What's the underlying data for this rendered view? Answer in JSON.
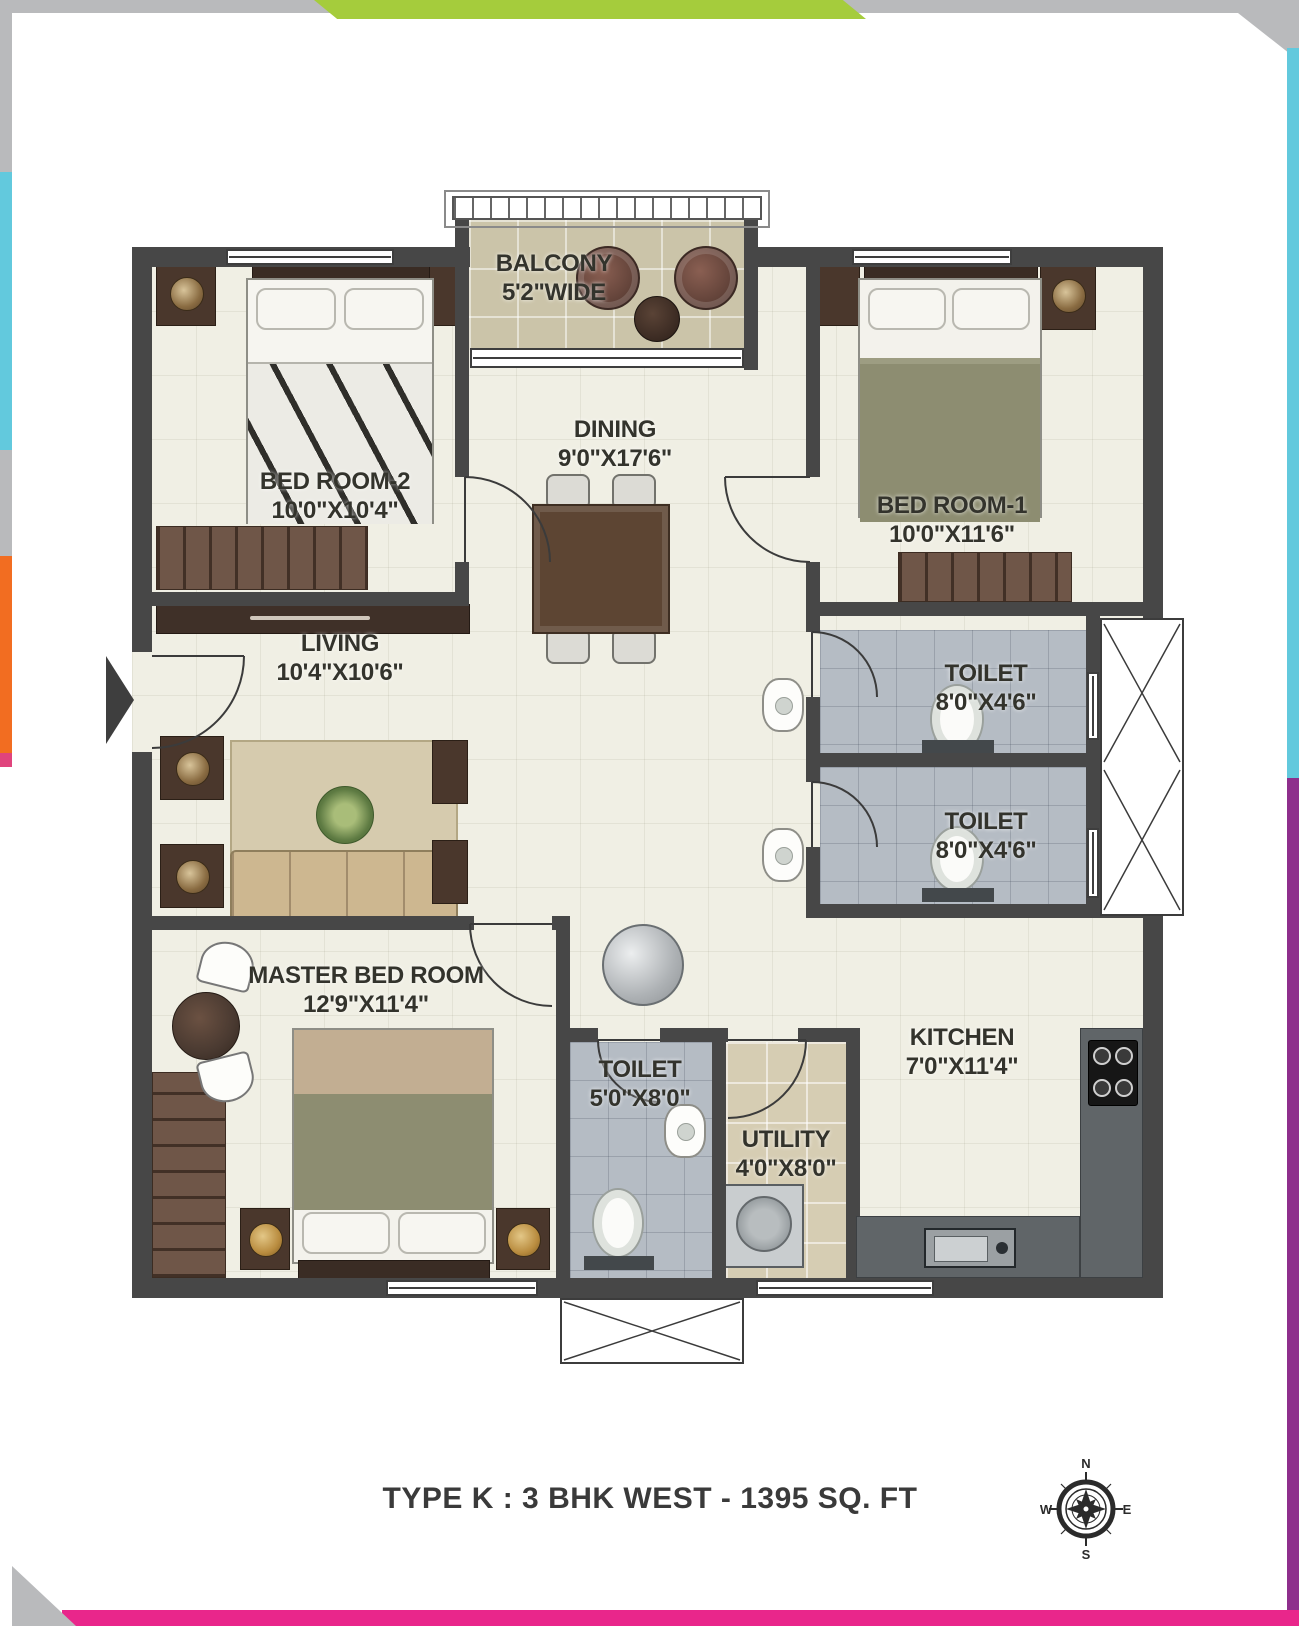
{
  "page": {
    "caption": "TYPE K : 3 BHK WEST - 1395 SQ. FT"
  },
  "rooms": {
    "balcony": {
      "name": "BALCONY",
      "dims": "5'2\"WIDE"
    },
    "bedroom2": {
      "name": "BED ROOM-2",
      "dims": "10'0\"X10'4\""
    },
    "dining": {
      "name": "DINING",
      "dims": "9'0\"X17'6\""
    },
    "bedroom1": {
      "name": "BED ROOM-1",
      "dims": "10'0\"X11'6\""
    },
    "living": {
      "name": "LIVING",
      "dims": "10'4\"X10'6\""
    },
    "toilet_top": {
      "name": "TOILET",
      "dims": "8'0\"X4'6\""
    },
    "toilet_mid": {
      "name": "TOILET",
      "dims": "8'0\"X4'6\""
    },
    "master": {
      "name": "MASTER BED ROOM",
      "dims": "12'9\"X11'4\""
    },
    "toilet_bottom": {
      "name": "TOILET",
      "dims": "5'0\"X8'0\""
    },
    "utility": {
      "name": "UTILITY",
      "dims": "4'0\"X8'0\""
    },
    "kitchen": {
      "name": "KITCHEN",
      "dims": "7'0\"X11'4\""
    }
  },
  "compass": {
    "north": "N",
    "south": "S",
    "east": "E",
    "west": "W"
  },
  "colors": {
    "frame_gray": "#b9babc",
    "frame_green": "#a5cc3c",
    "frame_cyan": "#62c9dd",
    "frame_orange": "#f26d21",
    "frame_purple": "#8e2f8c",
    "frame_pink": "#e9268b",
    "wall": "#474747",
    "floor": "#f0efe4",
    "toilet_floor": "#b5bcc4",
    "balcony_floor": "#cbc4a9",
    "utility_floor": "#d6cdb3"
  }
}
